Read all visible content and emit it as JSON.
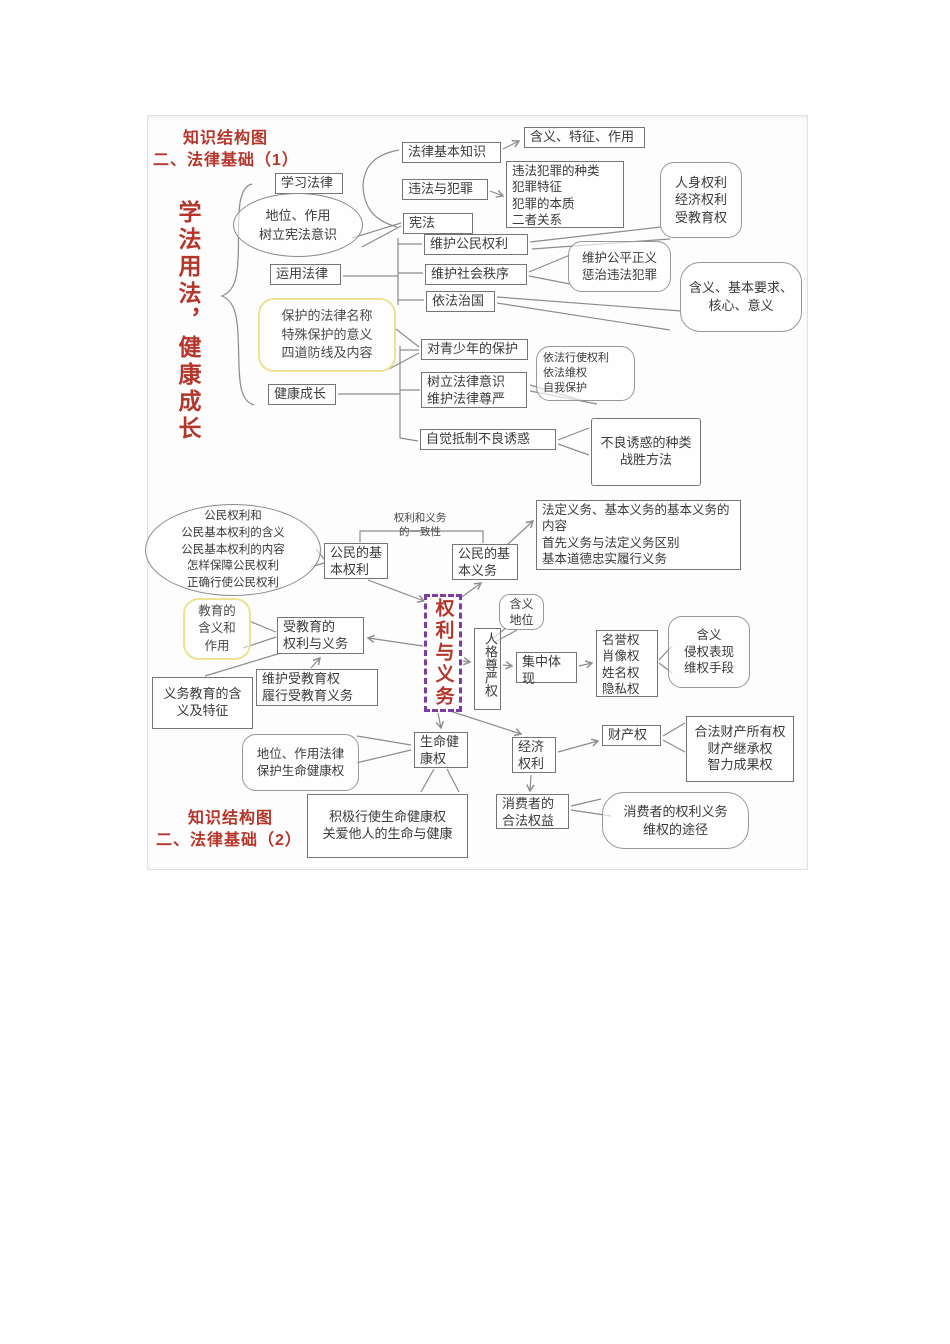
{
  "colors": {
    "accent_red": "#b5352b",
    "purple_dashed": "#7b3ca6",
    "yellow_border": "#ece291",
    "line_gray": "#8c8c8c",
    "box_border": "#757575"
  },
  "d1": {
    "title1": "知识结构图",
    "title2": "二、法律基础（1）",
    "root": "学法用法，健康成长",
    "study": "学习法律",
    "position_oval": "地位、作用\n树立宪法意识",
    "use_law": "运用法律",
    "protect_note": "保护的法律名称\n特殊保护的意义\n四道防线及内容",
    "healthy_growth": "健康成长",
    "basic_knowledge": "法律基本知识",
    "illegal_crime": "违法与犯罪",
    "constitution": "宪法",
    "meaning_feature": "含义、特征、作用",
    "crime_detail": "违法犯罪的种类\n犯罪特征\n犯罪的本质\n二者关系",
    "rights_bubble": "人身权利\n经济权利\n受教育权",
    "protect_rights": "维护公民权利",
    "protect_order": "维护社会秩序",
    "rule_of_law": "依法治国",
    "fairness": "维护公平正义\n惩治违法犯罪",
    "meaning_core": "含义、基本要求、\n核心、意义",
    "youth_protection": "对青少年的保护",
    "legal_awareness": "树立法律意识\n维护法律尊严",
    "exercise_rights": "依法行使权利\n依法维权\n自我保护",
    "resist_temptation": "自觉抵制不良诱惑",
    "temptation_detail": "不良诱惑的种类\n战胜方法"
  },
  "d2": {
    "title1": "知识结构图",
    "title2": "二、法律基础（2）",
    "civil_rights_oval": "公民权利和\n公民基本权利的含义\n公民基本权利的内容\n怎样保障公民权利\n正确行使公民权利",
    "consistency": "权利和义务\n的一致性",
    "basic_rights": "公民的基\n本权利",
    "basic_duties": "公民的基\n本义务",
    "legal_duties": "法定义务、基本义务的基本义务的\n内容\n首先义务与法定义务区别\n基本道德忠实履行义务",
    "center": "权利与义务",
    "meaning_status": "含义\n地位",
    "dignity": "人格尊严权",
    "embodiment": "集中体\n现",
    "reputation_list": "名誉权\n肖像权\n姓名权\n隐私权",
    "infringe_bubble": "含义\n侵权表现\n维权手段",
    "education_bubble": "教育的\n含义和\n作用",
    "edu_right_duty": "受教育的\n权利与义务",
    "compulsory_edu": "义务教育的含\n义及特征",
    "safeguard_edu": "维护受教育权\n履行受教育义务",
    "life_health": "生命健\n康权",
    "law_protect_life": "地位、作用法律\n保护生命健康权",
    "exercise_life": "积极行使生命健康权\n关爱他人的生命与健康",
    "economic": "经济\n权利",
    "property": "财产权",
    "property_detail": "合法财产所有权\n财产继承权\n智力成果权",
    "consumer": "消费者的\n合法权益",
    "consumer_bubble": "消费者的权利义务\n维权的途径"
  }
}
